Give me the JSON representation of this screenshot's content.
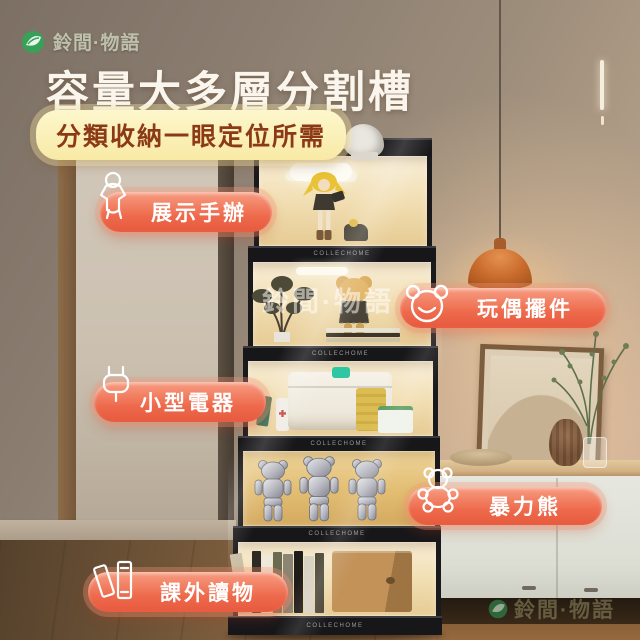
{
  "brand": {
    "logo_text": "鈴間·物語"
  },
  "header": {
    "title": "容量大多層分割槽",
    "subtitle": "分類收納一眼定位所需"
  },
  "feature_labels": [
    {
      "text": "展示手辦",
      "icon": "figurine-icon"
    },
    {
      "text": "玩偶擺件",
      "icon": "bear-face-icon"
    },
    {
      "text": "小型電器",
      "icon": "plug-icon"
    },
    {
      "text": "暴力熊",
      "icon": "teddy-bear-icon"
    },
    {
      "text": "課外讀物",
      "icon": "books-icon"
    }
  ],
  "watermarks": {
    "center_text": "鈴間·物語",
    "bottom_right_text": "鈴間·物語"
  },
  "cabinet": {
    "shelf_brand_text": "COLLECHOME",
    "tier_count": 5
  },
  "colors": {
    "accent_coral": "#ee6a4c",
    "subtitle_bg": "#fbf0b6",
    "subtitle_text": "#8c3a15",
    "logo_green": "#36a257",
    "frame_black": "#17171a",
    "interior_glow": "#f2dfb4"
  }
}
